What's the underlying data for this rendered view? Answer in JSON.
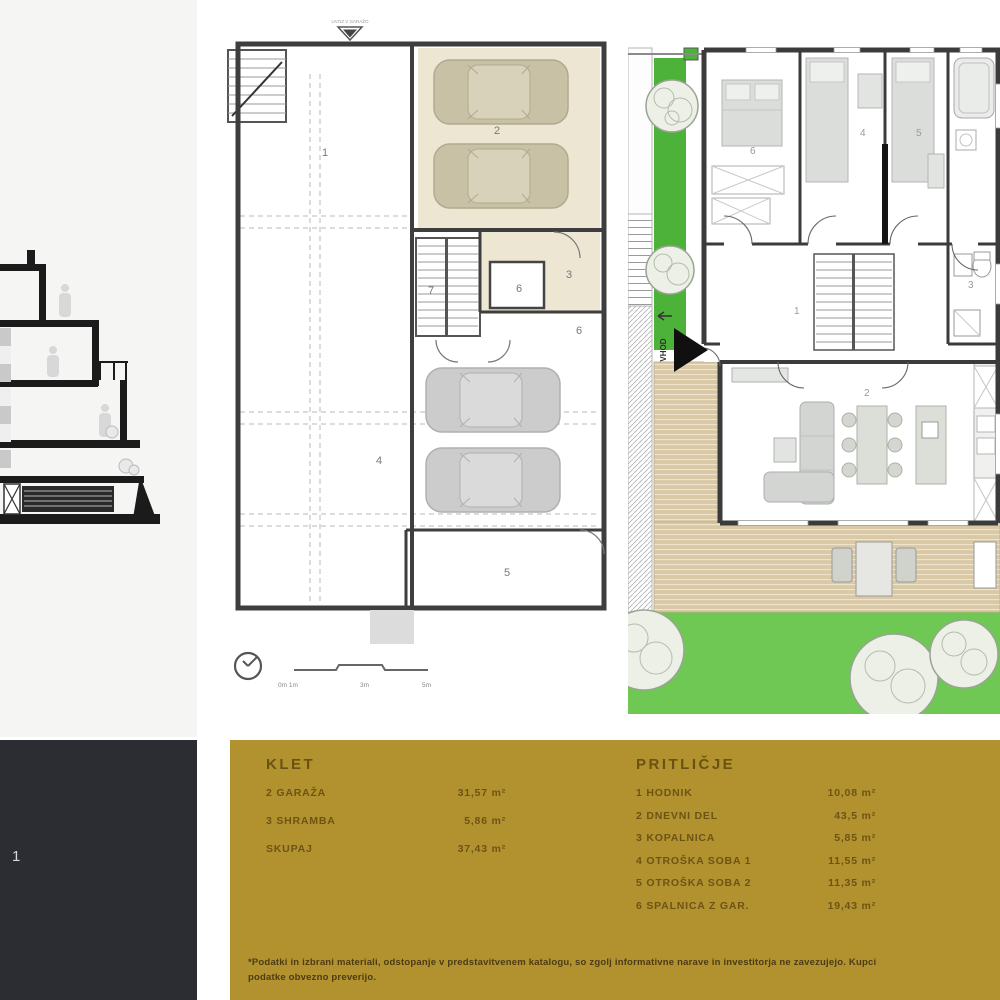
{
  "unit_panel": {
    "number": "1"
  },
  "basement": {
    "title_marker": "UVOZ V GARAŽO",
    "rooms": {
      "r1": "1",
      "r2": "2",
      "r3": "3",
      "r4": "4",
      "r5": "5",
      "r6a": "6",
      "r6b": "6",
      "r7": "7"
    },
    "scale_labels": {
      "zero": "0m  1m",
      "three": "3m",
      "five": "5m"
    }
  },
  "ground": {
    "entry_label": "VHOD",
    "rooms": {
      "hallway": "1",
      "living": "2",
      "bathroom": "3",
      "kid1": "4",
      "kid2": "5",
      "master": "6"
    }
  },
  "legend": {
    "klet": {
      "title": "KLET",
      "rows": [
        {
          "label": "2 GARAŽA",
          "value": "31,57 m²"
        },
        {
          "label": "3 SHRAMBA",
          "value": "5,86 m²"
        },
        {
          "label": "SKUPAJ",
          "value": "37,43 m²"
        }
      ]
    },
    "pritlicje": {
      "title": "PRITLIČJE",
      "rows": [
        {
          "label": "1 HODNIK",
          "value": "10,08 m²"
        },
        {
          "label": "2 DNEVNI DEL",
          "value": "43,5 m²"
        },
        {
          "label": "3 KOPALNICA",
          "value": "5,85 m²"
        },
        {
          "label": "4 OTROŠKA SOBA 1",
          "value": "11,55 m²"
        },
        {
          "label": "5 OTROŠKA SOBA 2",
          "value": "11,35 m²"
        },
        {
          "label": "6 SPALNICA Z GAR.",
          "value": "19,43 m²"
        }
      ]
    },
    "footnote_line1": "*Podatki in izbrani materiali, odstopanje v predstavitvenem katalogu, so zgolj informativne narave in investitorja ne zavezujejo. Kupci",
    "footnote_line2": "podatke obvezno preverijo."
  },
  "colors": {
    "gold": "#b2912f",
    "dark_panel": "#2b2d33",
    "grass_strip": "#4db23a",
    "lawn": "#6ec853",
    "deck": "#d9c9a7",
    "beige_floor": "#ece6d3"
  }
}
